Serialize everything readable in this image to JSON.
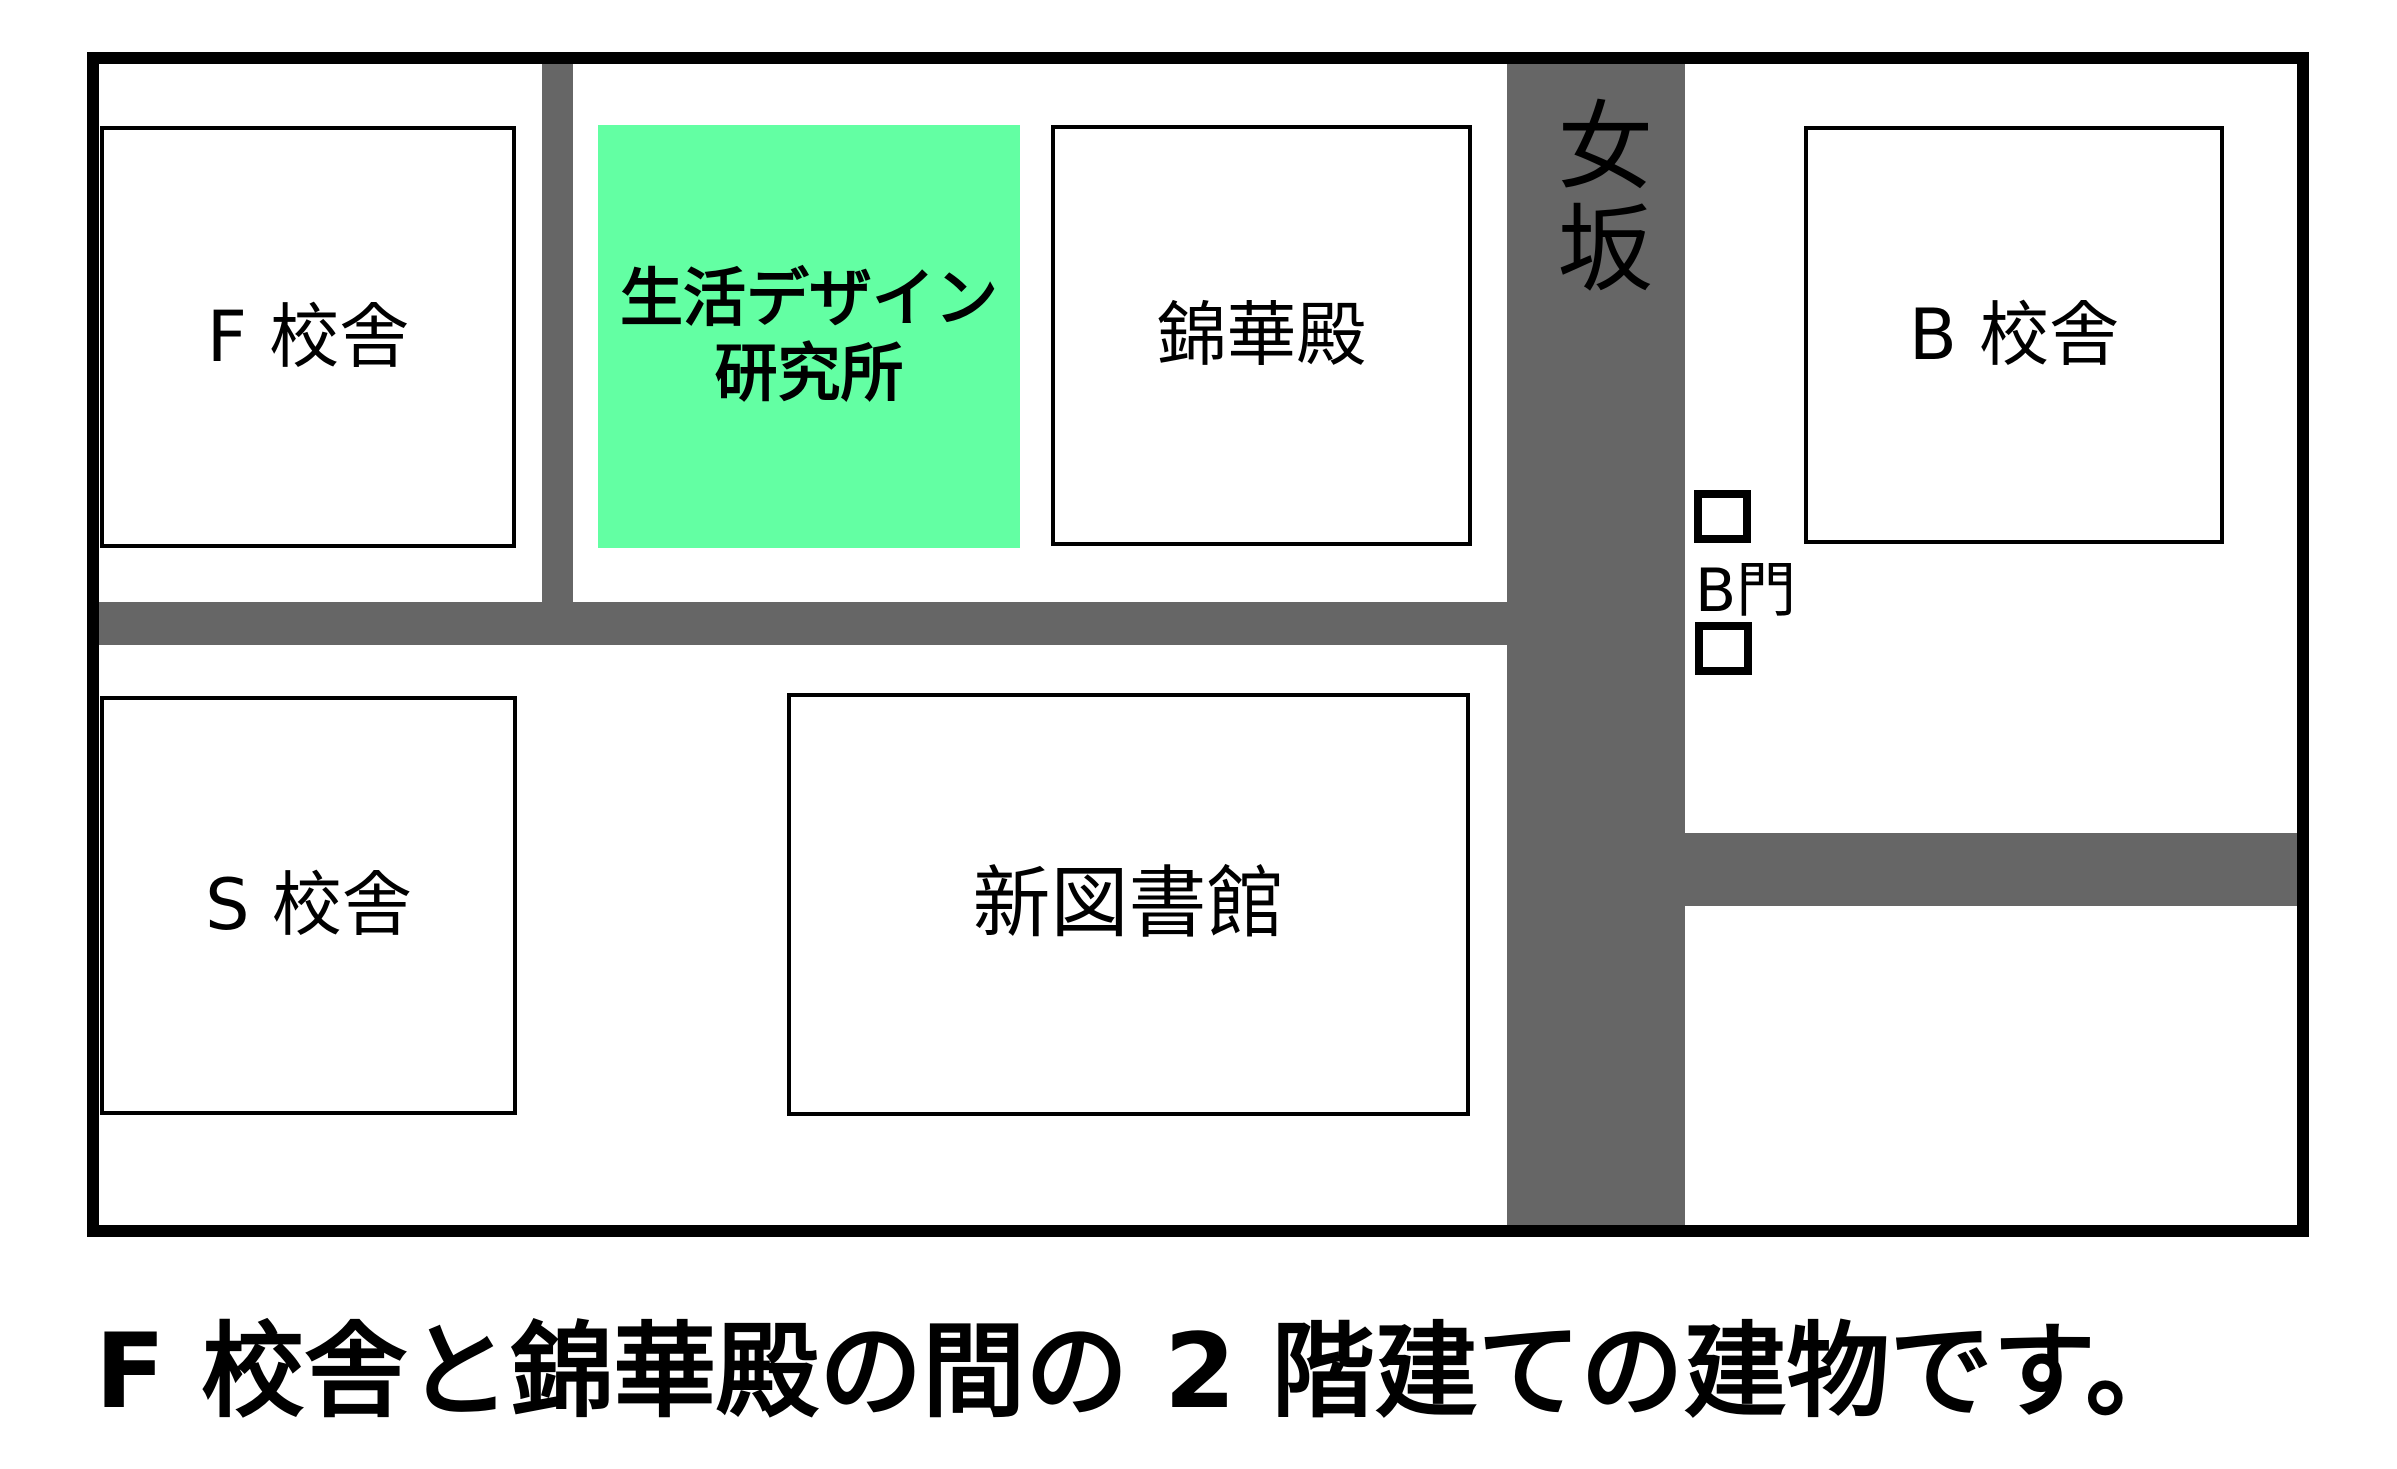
{
  "map": {
    "roads": {
      "onnazaka_label": "女坂"
    },
    "buildings": [
      {
        "name": "f-building",
        "label": "F 校舎"
      },
      {
        "name": "design-institute",
        "label_line1": "生活デザイン",
        "label_line2": "研究所",
        "highlighted": true
      },
      {
        "name": "kinkaden",
        "label": "錦華殿"
      },
      {
        "name": "b-building",
        "label": "B 校舎"
      },
      {
        "name": "s-building",
        "label": "S 校舎"
      },
      {
        "name": "new-library",
        "label": "新図書館"
      }
    ],
    "gate": {
      "label": "B門"
    },
    "colors": {
      "highlight_green": "#63FFA3",
      "road_gray": "#666666"
    }
  },
  "caption": "F 校舎と錦華殿の間の 2 階建ての建物です。"
}
